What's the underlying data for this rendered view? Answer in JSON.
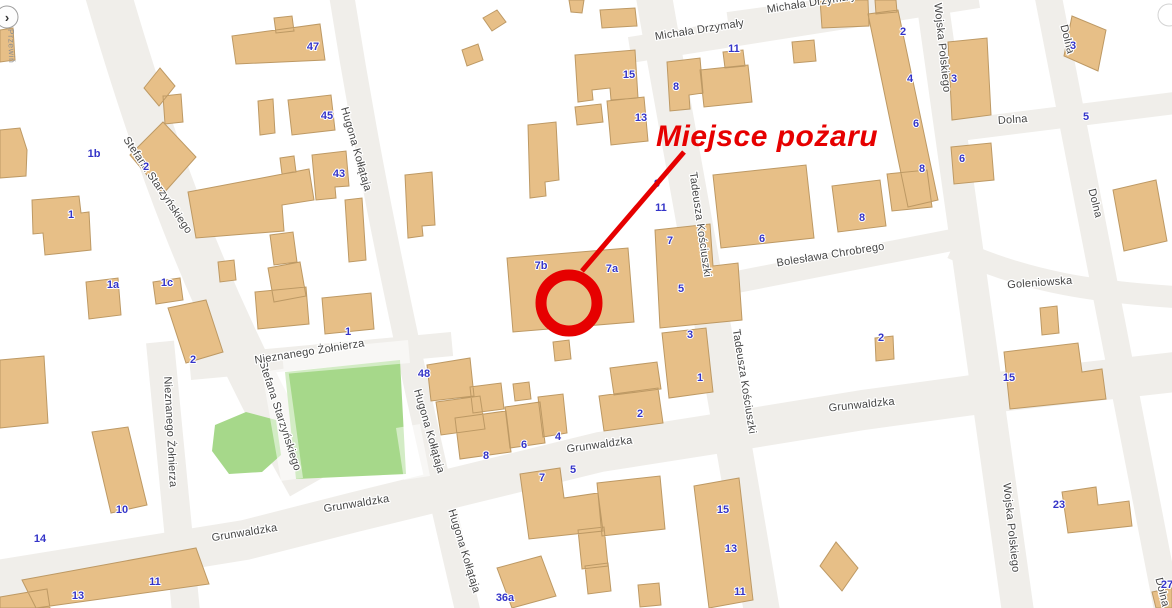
{
  "map": {
    "annotation": {
      "label": "Miejsce pożaru",
      "color": "#e60000"
    },
    "controls": {
      "pan_toggle_glyph": "›",
      "pan_toggle_label": "Przewiń"
    },
    "colors": {
      "building_fill": "#e7bf87",
      "building_stroke": "#bd9964",
      "road_fill": "#f0eeea",
      "park_fill": "#a6d88a",
      "street_label": "#454545",
      "number_label": "#3434c8",
      "accent_red": "#e60000"
    },
    "streets": {
      "michala_drzymaly": "Michała Drzymały",
      "wojska_polskiego": "Wojska Polskiego",
      "dolna": "Dolna",
      "goleniowska": "Goleniowska",
      "boleslawa_chrobrego": "Bolesława Chrobrego",
      "tadeusza_kosciuszki": "Tadeusza Kościuszki",
      "stefana_starzynskiego": "Stefana Starzyńskiego",
      "nieznanego_zolnierza": "Nieznanego Żołnierza",
      "hugona_kollataja": "Hugona Kołłątaja",
      "grunwaldzka": "Grunwaldzka"
    },
    "street_label_instances": [
      {
        "street": "michala_drzymaly",
        "x": 700,
        "y": 33,
        "r": -9
      },
      {
        "street": "michala_drzymaly",
        "x": 812,
        "y": 6,
        "r": -9
      },
      {
        "street": "wojska_polskiego",
        "x": 939,
        "y": 48,
        "r": 84
      },
      {
        "street": "wojska_polskiego",
        "x": 1008,
        "y": 528,
        "r": 84
      },
      {
        "street": "dolna",
        "x": 1064,
        "y": 40,
        "r": 76
      },
      {
        "street": "dolna",
        "x": 1013,
        "y": 123,
        "r": -4
      },
      {
        "street": "dolna",
        "x": 1092,
        "y": 204,
        "r": 76
      },
      {
        "street": "dolna",
        "x": 1159,
        "y": 593,
        "r": 76
      },
      {
        "street": "goleniowska",
        "x": 1040,
        "y": 286,
        "r": -4
      },
      {
        "street": "boleslawa_chrobrego",
        "x": 831,
        "y": 258,
        "r": -9
      },
      {
        "street": "tadeusza_kosciuszki",
        "x": 697,
        "y": 225,
        "r": 82
      },
      {
        "street": "tadeusza_kosciuszki",
        "x": 741,
        "y": 382,
        "r": 81
      },
      {
        "street": "stefana_starzynskiego",
        "x": 155,
        "y": 187,
        "r": 56
      },
      {
        "street": "stefana_starzynskiego",
        "x": 277,
        "y": 417,
        "r": 72
      },
      {
        "street": "nieznanego_zolnierza",
        "x": 310,
        "y": 355,
        "r": -9
      },
      {
        "street": "nieznanego_zolnierza",
        "x": 167,
        "y": 432,
        "r": 87
      },
      {
        "street": "hugona_kollataja",
        "x": 353,
        "y": 150,
        "r": 74
      },
      {
        "street": "hugona_kollataja",
        "x": 426,
        "y": 432,
        "r": 74
      },
      {
        "street": "hugona_kollataja",
        "x": 461,
        "y": 552,
        "r": 73
      },
      {
        "street": "grunwaldzka",
        "x": 600,
        "y": 448,
        "r": -8
      },
      {
        "street": "grunwaldzka",
        "x": 862,
        "y": 408,
        "r": -6
      },
      {
        "street": "grunwaldzka",
        "x": 245,
        "y": 536,
        "r": -9
      },
      {
        "street": "grunwaldzka",
        "x": 357,
        "y": 507,
        "r": -9
      }
    ],
    "building_numbers": [
      {
        "t": "47",
        "x": 313,
        "y": 46
      },
      {
        "t": "45",
        "x": 327,
        "y": 115
      },
      {
        "t": "43",
        "x": 339,
        "y": 173
      },
      {
        "t": "1b",
        "x": 94,
        "y": 153
      },
      {
        "t": "2",
        "x": 146,
        "y": 166
      },
      {
        "t": "1",
        "x": 71,
        "y": 214
      },
      {
        "t": "1a",
        "x": 113,
        "y": 284
      },
      {
        "t": "1c",
        "x": 167,
        "y": 282
      },
      {
        "t": "2",
        "x": 193,
        "y": 359
      },
      {
        "t": "1",
        "x": 348,
        "y": 331
      },
      {
        "t": "15",
        "x": 629,
        "y": 74
      },
      {
        "t": "13",
        "x": 641,
        "y": 117
      },
      {
        "t": "8",
        "x": 676,
        "y": 86
      },
      {
        "t": "11",
        "x": 734,
        "y": 48
      },
      {
        "t": "2",
        "x": 903,
        "y": 31
      },
      {
        "t": "4",
        "x": 910,
        "y": 78
      },
      {
        "t": "6",
        "x": 916,
        "y": 123
      },
      {
        "t": "8",
        "x": 922,
        "y": 168
      },
      {
        "t": "3",
        "x": 954,
        "y": 78
      },
      {
        "t": "6",
        "x": 962,
        "y": 158
      },
      {
        "t": "3",
        "x": 1073,
        "y": 45
      },
      {
        "t": "5",
        "x": 1086,
        "y": 116
      },
      {
        "t": "8",
        "x": 862,
        "y": 217
      },
      {
        "t": "6",
        "x": 762,
        "y": 238
      },
      {
        "t": "9",
        "x": 657,
        "y": 183
      },
      {
        "t": "11",
        "x": 661,
        "y": 207
      },
      {
        "t": "7",
        "x": 670,
        "y": 240
      },
      {
        "t": "7b",
        "x": 541,
        "y": 265
      },
      {
        "t": "7a",
        "x": 612,
        "y": 268
      },
      {
        "t": "5",
        "x": 681,
        "y": 288
      },
      {
        "t": "3",
        "x": 690,
        "y": 334
      },
      {
        "t": "1",
        "x": 700,
        "y": 377
      },
      {
        "t": "2",
        "x": 640,
        "y": 413
      },
      {
        "t": "2",
        "x": 881,
        "y": 337
      },
      {
        "t": "15",
        "x": 1009,
        "y": 377
      },
      {
        "t": "23",
        "x": 1059,
        "y": 504
      },
      {
        "t": "48",
        "x": 424,
        "y": 373
      },
      {
        "t": "8",
        "x": 486,
        "y": 455
      },
      {
        "t": "6",
        "x": 524,
        "y": 444
      },
      {
        "t": "4",
        "x": 558,
        "y": 436
      },
      {
        "t": "7",
        "x": 542,
        "y": 477
      },
      {
        "t": "5",
        "x": 573,
        "y": 469
      },
      {
        "t": "15",
        "x": 723,
        "y": 509
      },
      {
        "t": "13",
        "x": 731,
        "y": 548
      },
      {
        "t": "11",
        "x": 740,
        "y": 591
      },
      {
        "t": "36a",
        "x": 505,
        "y": 597
      },
      {
        "t": "10",
        "x": 122,
        "y": 509
      },
      {
        "t": "14",
        "x": 40,
        "y": 538
      },
      {
        "t": "13",
        "x": 78,
        "y": 595
      },
      {
        "t": "11",
        "x": 155,
        "y": 581
      },
      {
        "t": "27",
        "x": 1167,
        "y": 584
      }
    ]
  }
}
